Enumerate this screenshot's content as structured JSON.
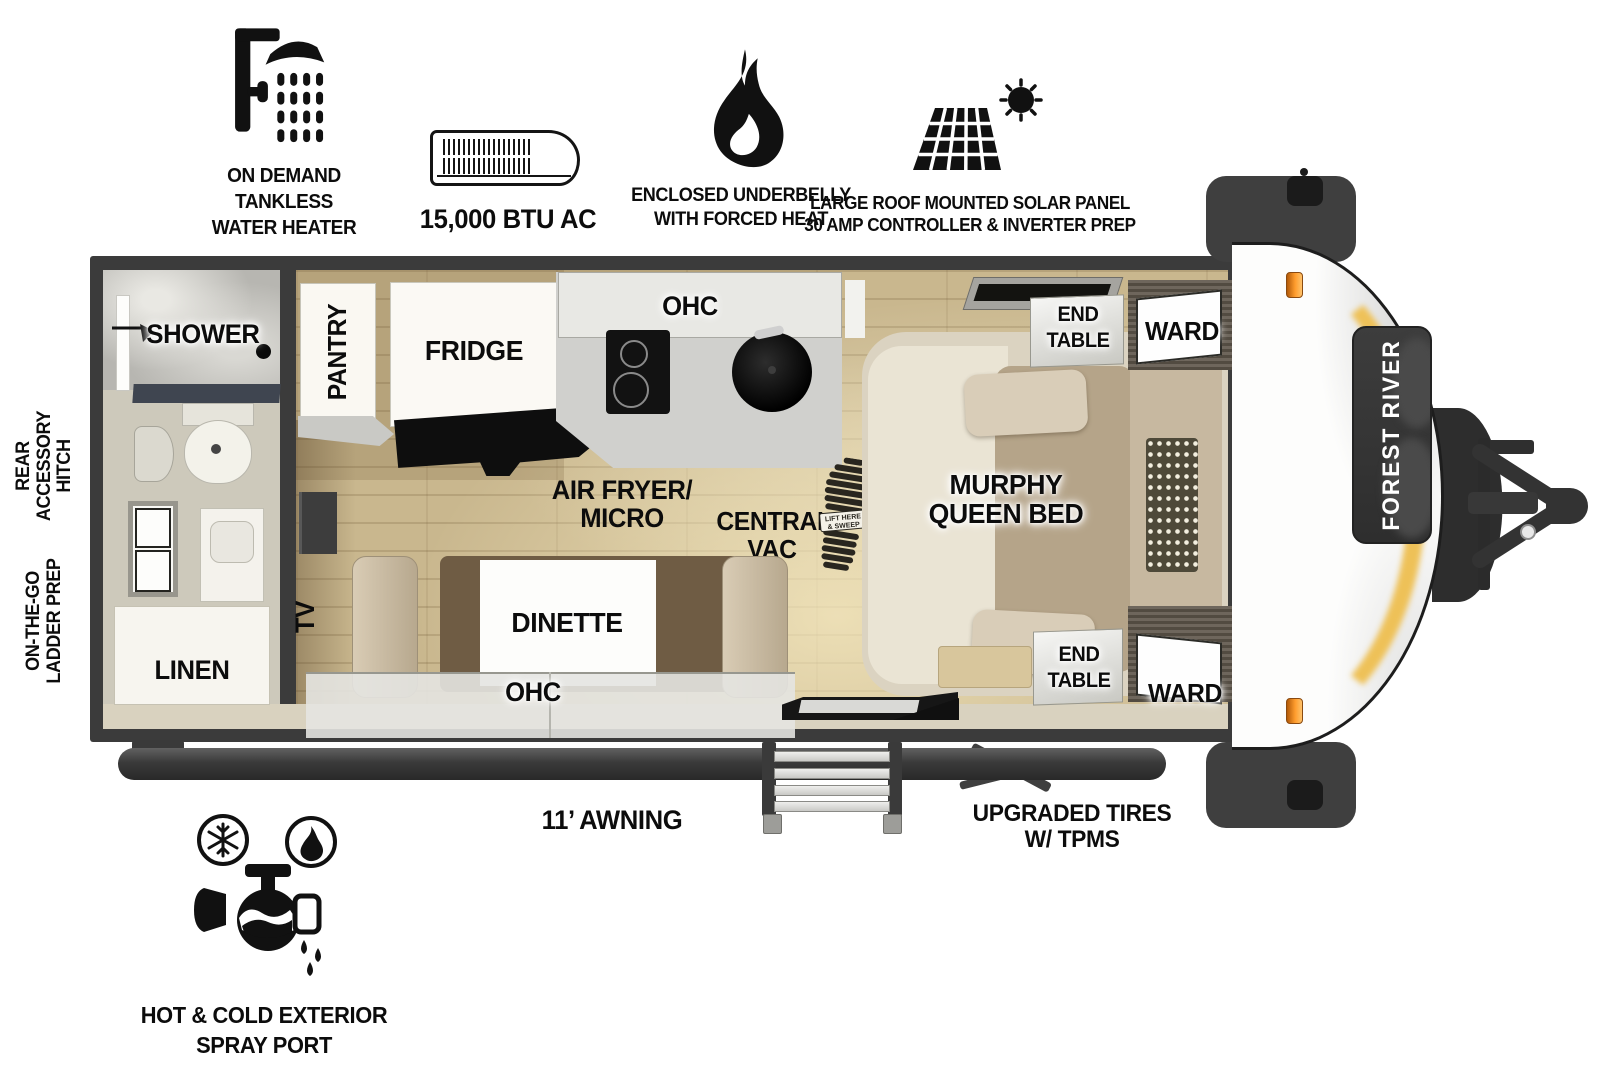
{
  "title": "Forest River travel trailer floorplan",
  "brand": "FOREST RIVER",
  "features_top": [
    {
      "icon": "tankless-water-heater-icon",
      "lines": [
        "ON DEMAND",
        "TANKLESS",
        "WATER HEATER"
      ]
    },
    {
      "icon": "ac-unit-icon",
      "lines": [
        "15,000 BTU AC"
      ]
    },
    {
      "icon": "flame-icon",
      "lines": [
        "ENCLOSED UNDERBELLY",
        "WITH FORCED HEAT"
      ]
    },
    {
      "icon": "solar-panel-icon",
      "lines": [
        "LARGE ROOF MOUNTED SOLAR PANEL",
        "30 AMP CONTROLLER & INVERTER PREP"
      ]
    }
  ],
  "side_labels": {
    "rear_hitch": [
      "REAR",
      "ACCESSORY",
      "HITCH"
    ],
    "ladder_prep": [
      "ON-THE-GO",
      "LADDER PREP"
    ]
  },
  "rooms": {
    "shower": "SHOWER",
    "linen": "LINEN",
    "pantry": "PANTRY",
    "fridge": "FRIDGE",
    "ohc_kitchen": "OHC",
    "air_fryer_line1": "AIR FRYER/",
    "air_fryer_line2": "MICRO",
    "central_vac_line1": "CENTRAL",
    "central_vac_line2": "VAC",
    "vac_sticker_line1": "LIFT HERE",
    "vac_sticker_line2": "& SWEEP",
    "tv": "TV",
    "dinette": "DINETTE",
    "ohc_dinette": "OHC",
    "murphy_line1": "MURPHY",
    "murphy_line2": "QUEEN BED",
    "end_table_line1": "END",
    "end_table_line2": "TABLE",
    "ward": "WARD"
  },
  "exterior": {
    "awning": "11’ AWNING",
    "tires_line1": "UPGRADED TIRES",
    "tires_line2": "W/ TPMS",
    "spray_line1": "HOT & COLD EXTERIOR",
    "spray_line2": "SPRAY PORT"
  },
  "colors": {
    "wall": "#3B3B3B",
    "wood_floor": "#C9B78E",
    "accent_amber": "#EEC158",
    "marker_light": "#F7941D"
  }
}
